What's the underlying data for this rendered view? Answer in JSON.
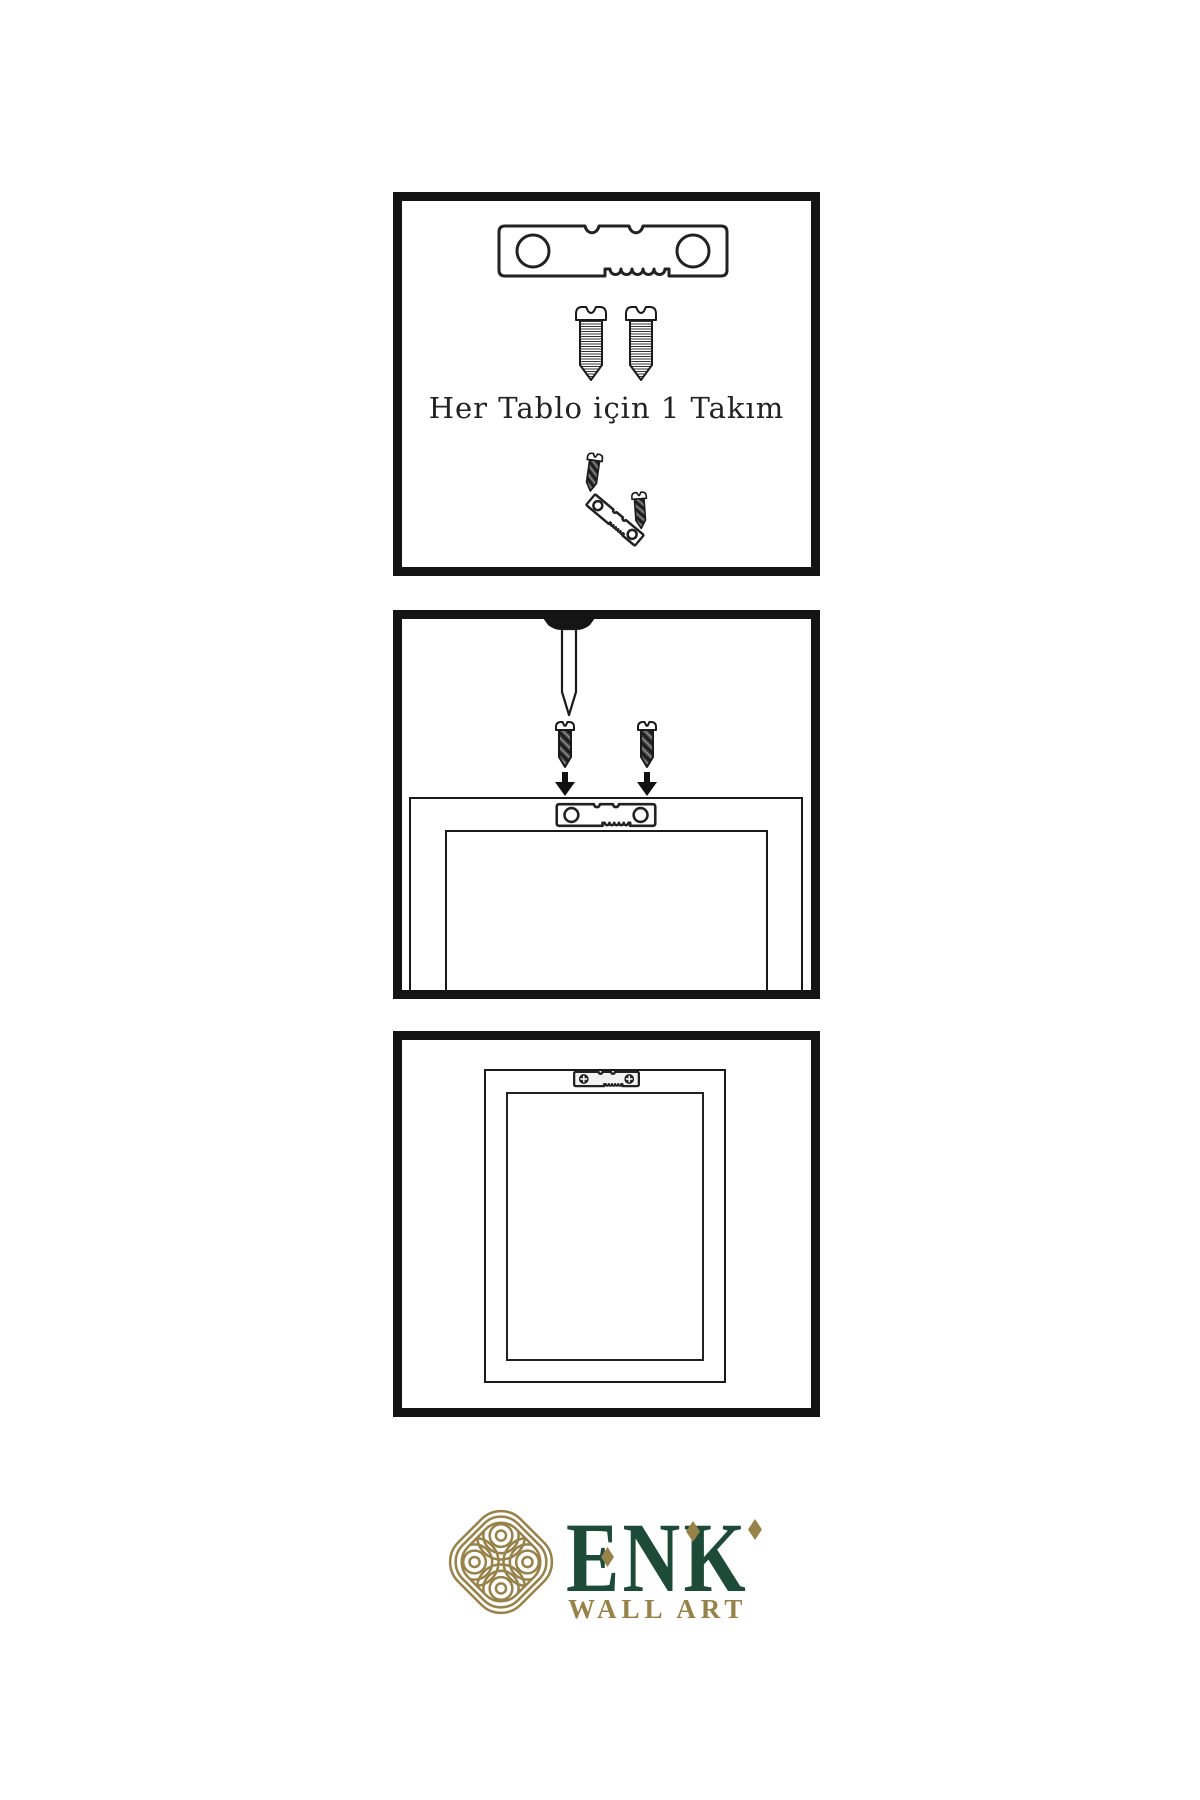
{
  "page": {
    "width": 1200,
    "height": 1800,
    "background": "#ffffff",
    "type": "wall-art-hanging-instruction-diagram",
    "language": "Turkish"
  },
  "panel1": {
    "name": "hardware-kit",
    "caption": "Her Tablo için 1 Takım",
    "items": [
      "sawtooth-hanger",
      "screw",
      "screw",
      "screw",
      "tilted-sawtooth-hanger",
      "screw"
    ]
  },
  "panel2": {
    "name": "mounting-diagram",
    "items": [
      "wall-nail",
      "dark-screw",
      "dark-screw",
      "down-arrow",
      "down-arrow",
      "frame-back-outline",
      "sawtooth-hanger"
    ]
  },
  "panel3": {
    "name": "hung-frame",
    "items": [
      "frame-front-outline",
      "sawtooth-hanger-with-screws"
    ]
  },
  "logo": {
    "brand": "ENK",
    "subtitle": "WALL ART",
    "icon": "interlaced-knot"
  },
  "colors": {
    "line": "#1a1a1a",
    "panel_border": "#141414",
    "brand_gold": "#97824a",
    "brand_green": "#1e4a3a",
    "background": "#ffffff"
  }
}
